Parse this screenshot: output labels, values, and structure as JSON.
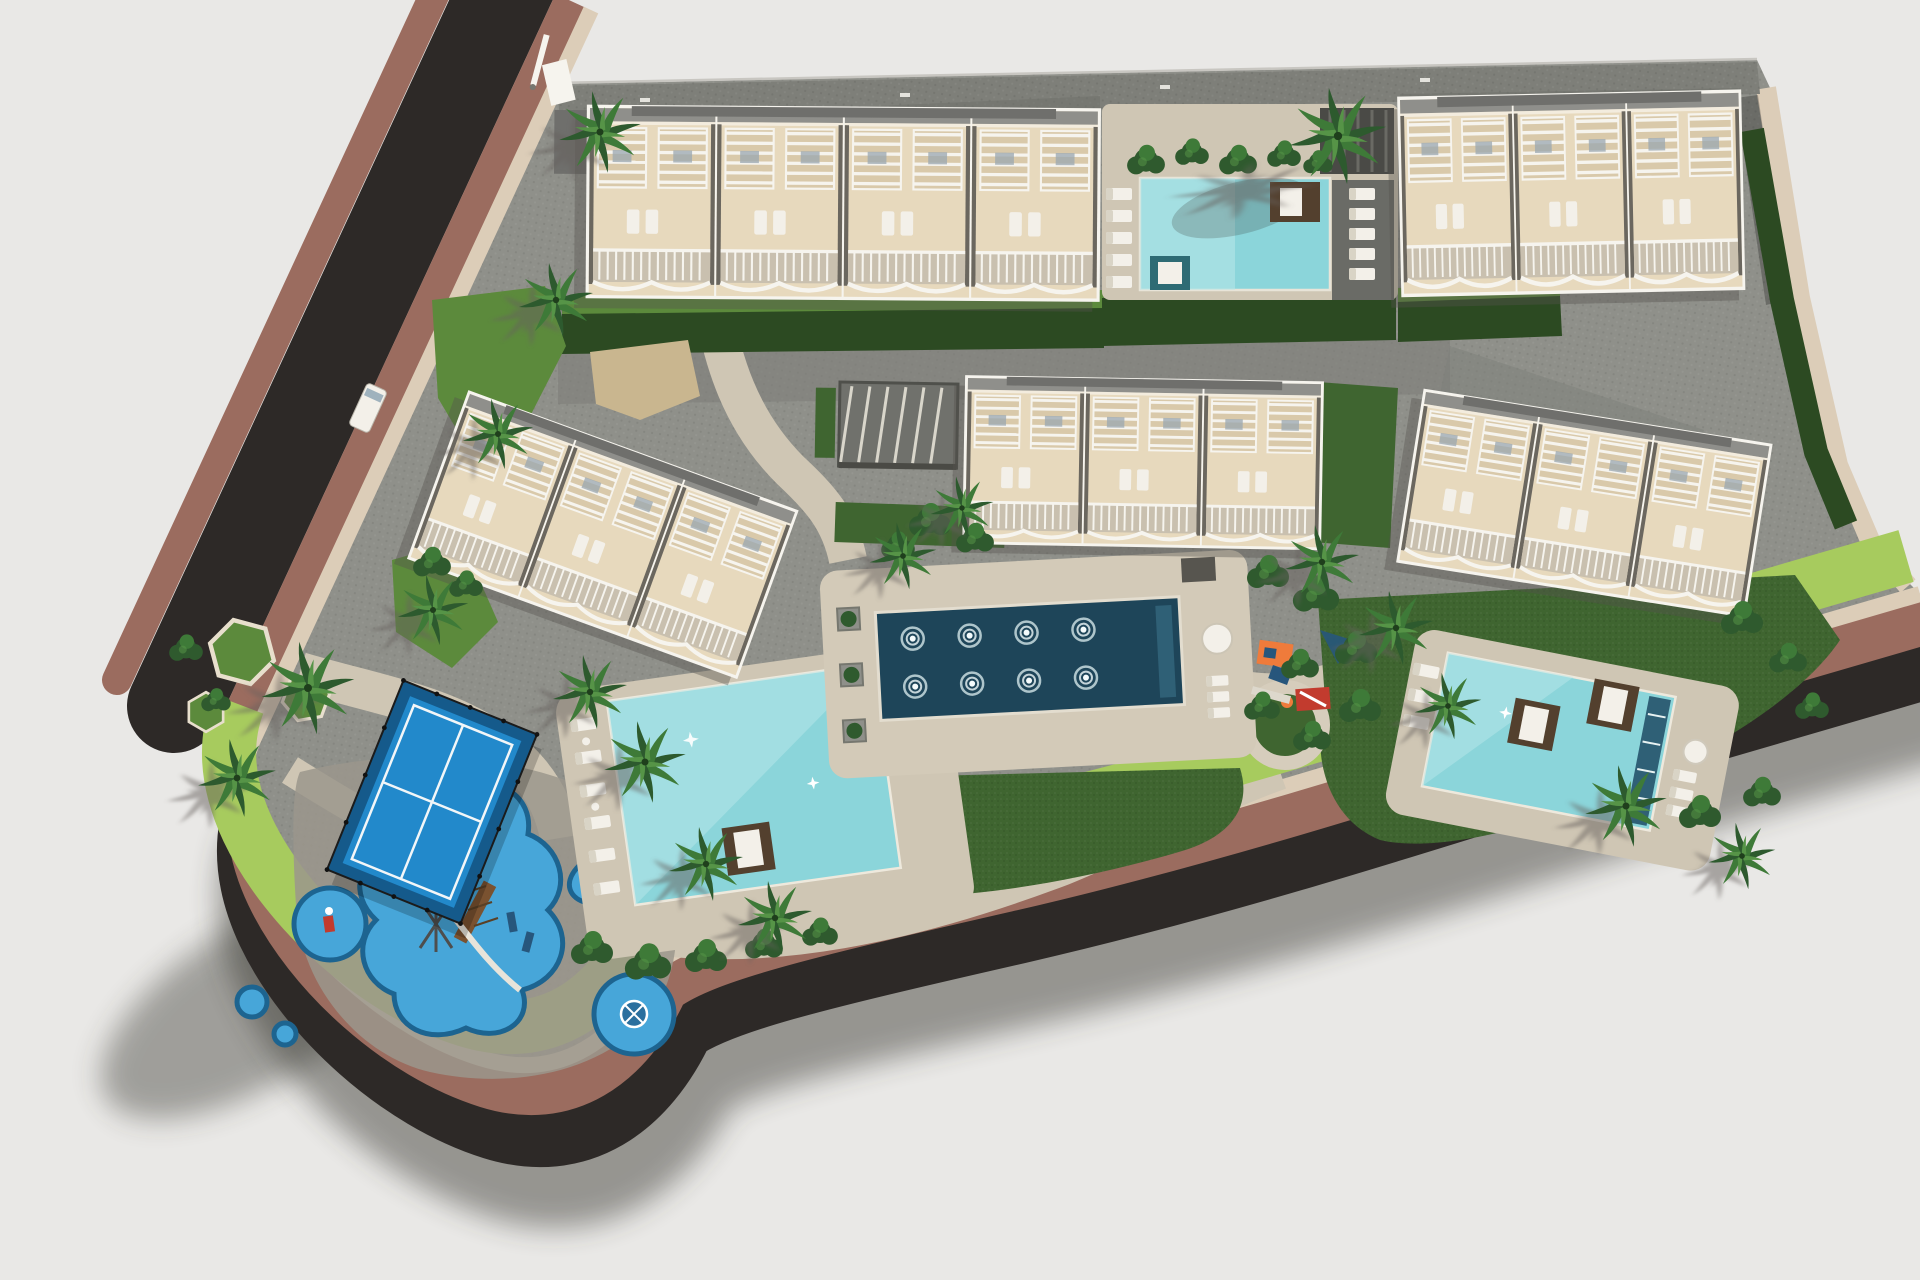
{
  "meta": {
    "title": "Aerial 3D site-plan render of a residential complex with five apartment blocks, three swimming pools, a fountain pool, a padel court and playgrounds"
  },
  "palette": {
    "bg": "#e9e8e6",
    "road_asphalt": "#2d2927",
    "sidewalk_brown": "#9b6c5f",
    "curb_beige": "#dccdb8",
    "paving": "#8f908a",
    "paving_dark": "#7e7f79",
    "path_beige": "#cfc6b4",
    "lawn": "#3f6530",
    "lawn_bright": "#5c8a3c",
    "lawn_lime": "#a7cb5e",
    "hedge": "#2c4a22",
    "shrub": "#2f5a2e",
    "building_cream": "#e7d9bd",
    "building_cream_dark": "#d9c9aa",
    "building_white": "#f6f4ee",
    "building_roof": "#8f8f8b",
    "building_roof_dark": "#6f6f6c",
    "building_divider": "#6b675f",
    "balcony_floor": "#c9c0af",
    "building_shadow": "#55524d",
    "pool_light": "#8bd5da",
    "pool_lighter": "#b9e7e9",
    "fountain_pool": "#1e4559",
    "fountain_step": "#2f6076",
    "court_blue": "#2289cb",
    "court_blue_dark": "#155a8b",
    "court_line": "#f2f6f8",
    "fence_dark": "#1b1b1b",
    "play_blue": "#47a6d9",
    "play_blue_border": "#1d6490",
    "equip_orange": "#ef7b3b",
    "equip_red": "#c23b2e",
    "equip_navy": "#27567c",
    "daybed_brown": "#53402e",
    "lounger_white": "#f3f0e9",
    "palm_dark": "#2d5a2e",
    "palm_mid": "#3e7a38",
    "palm_light": "#569447",
    "shadow": "#33302c"
  },
  "scene": {
    "type": "aerial-architectural-render",
    "features": {
      "buildings": [
        {
          "id": "b1",
          "label": "Apartment block - north west"
        },
        {
          "id": "b2",
          "label": "Apartment block - north east"
        },
        {
          "id": "b3",
          "label": "Apartment block - west, rotated"
        },
        {
          "id": "b4",
          "label": "Apartment block - centre"
        },
        {
          "id": "b5",
          "label": "Apartment block - east, rotated"
        }
      ],
      "pools": [
        {
          "id": "pool-north",
          "label": "Swimming pool - north terrace"
        },
        {
          "id": "pool-west",
          "label": "Swimming pool - west terrace"
        },
        {
          "id": "pool-east",
          "label": "Swimming pool - east terrace"
        },
        {
          "id": "fountain-pool",
          "label": "Ornamental fountain pool with 8 jets"
        }
      ],
      "amenities": [
        {
          "id": "padel-court",
          "label": "Padel court with fencing"
        },
        {
          "id": "playground-sw",
          "label": "Children's playground - south west"
        },
        {
          "id": "playground-central",
          "label": "Children's playground - central"
        },
        {
          "id": "road",
          "label": "Perimeter road with brown sidewalks"
        },
        {
          "id": "parking",
          "label": "Paved parking strip - north edge"
        }
      ]
    },
    "counts": {
      "buildings": 5,
      "swimming_pools": 3,
      "fountain_jets": 8,
      "palm_trees": 18,
      "shrub_clusters": 28,
      "playground_islands": 6
    }
  }
}
